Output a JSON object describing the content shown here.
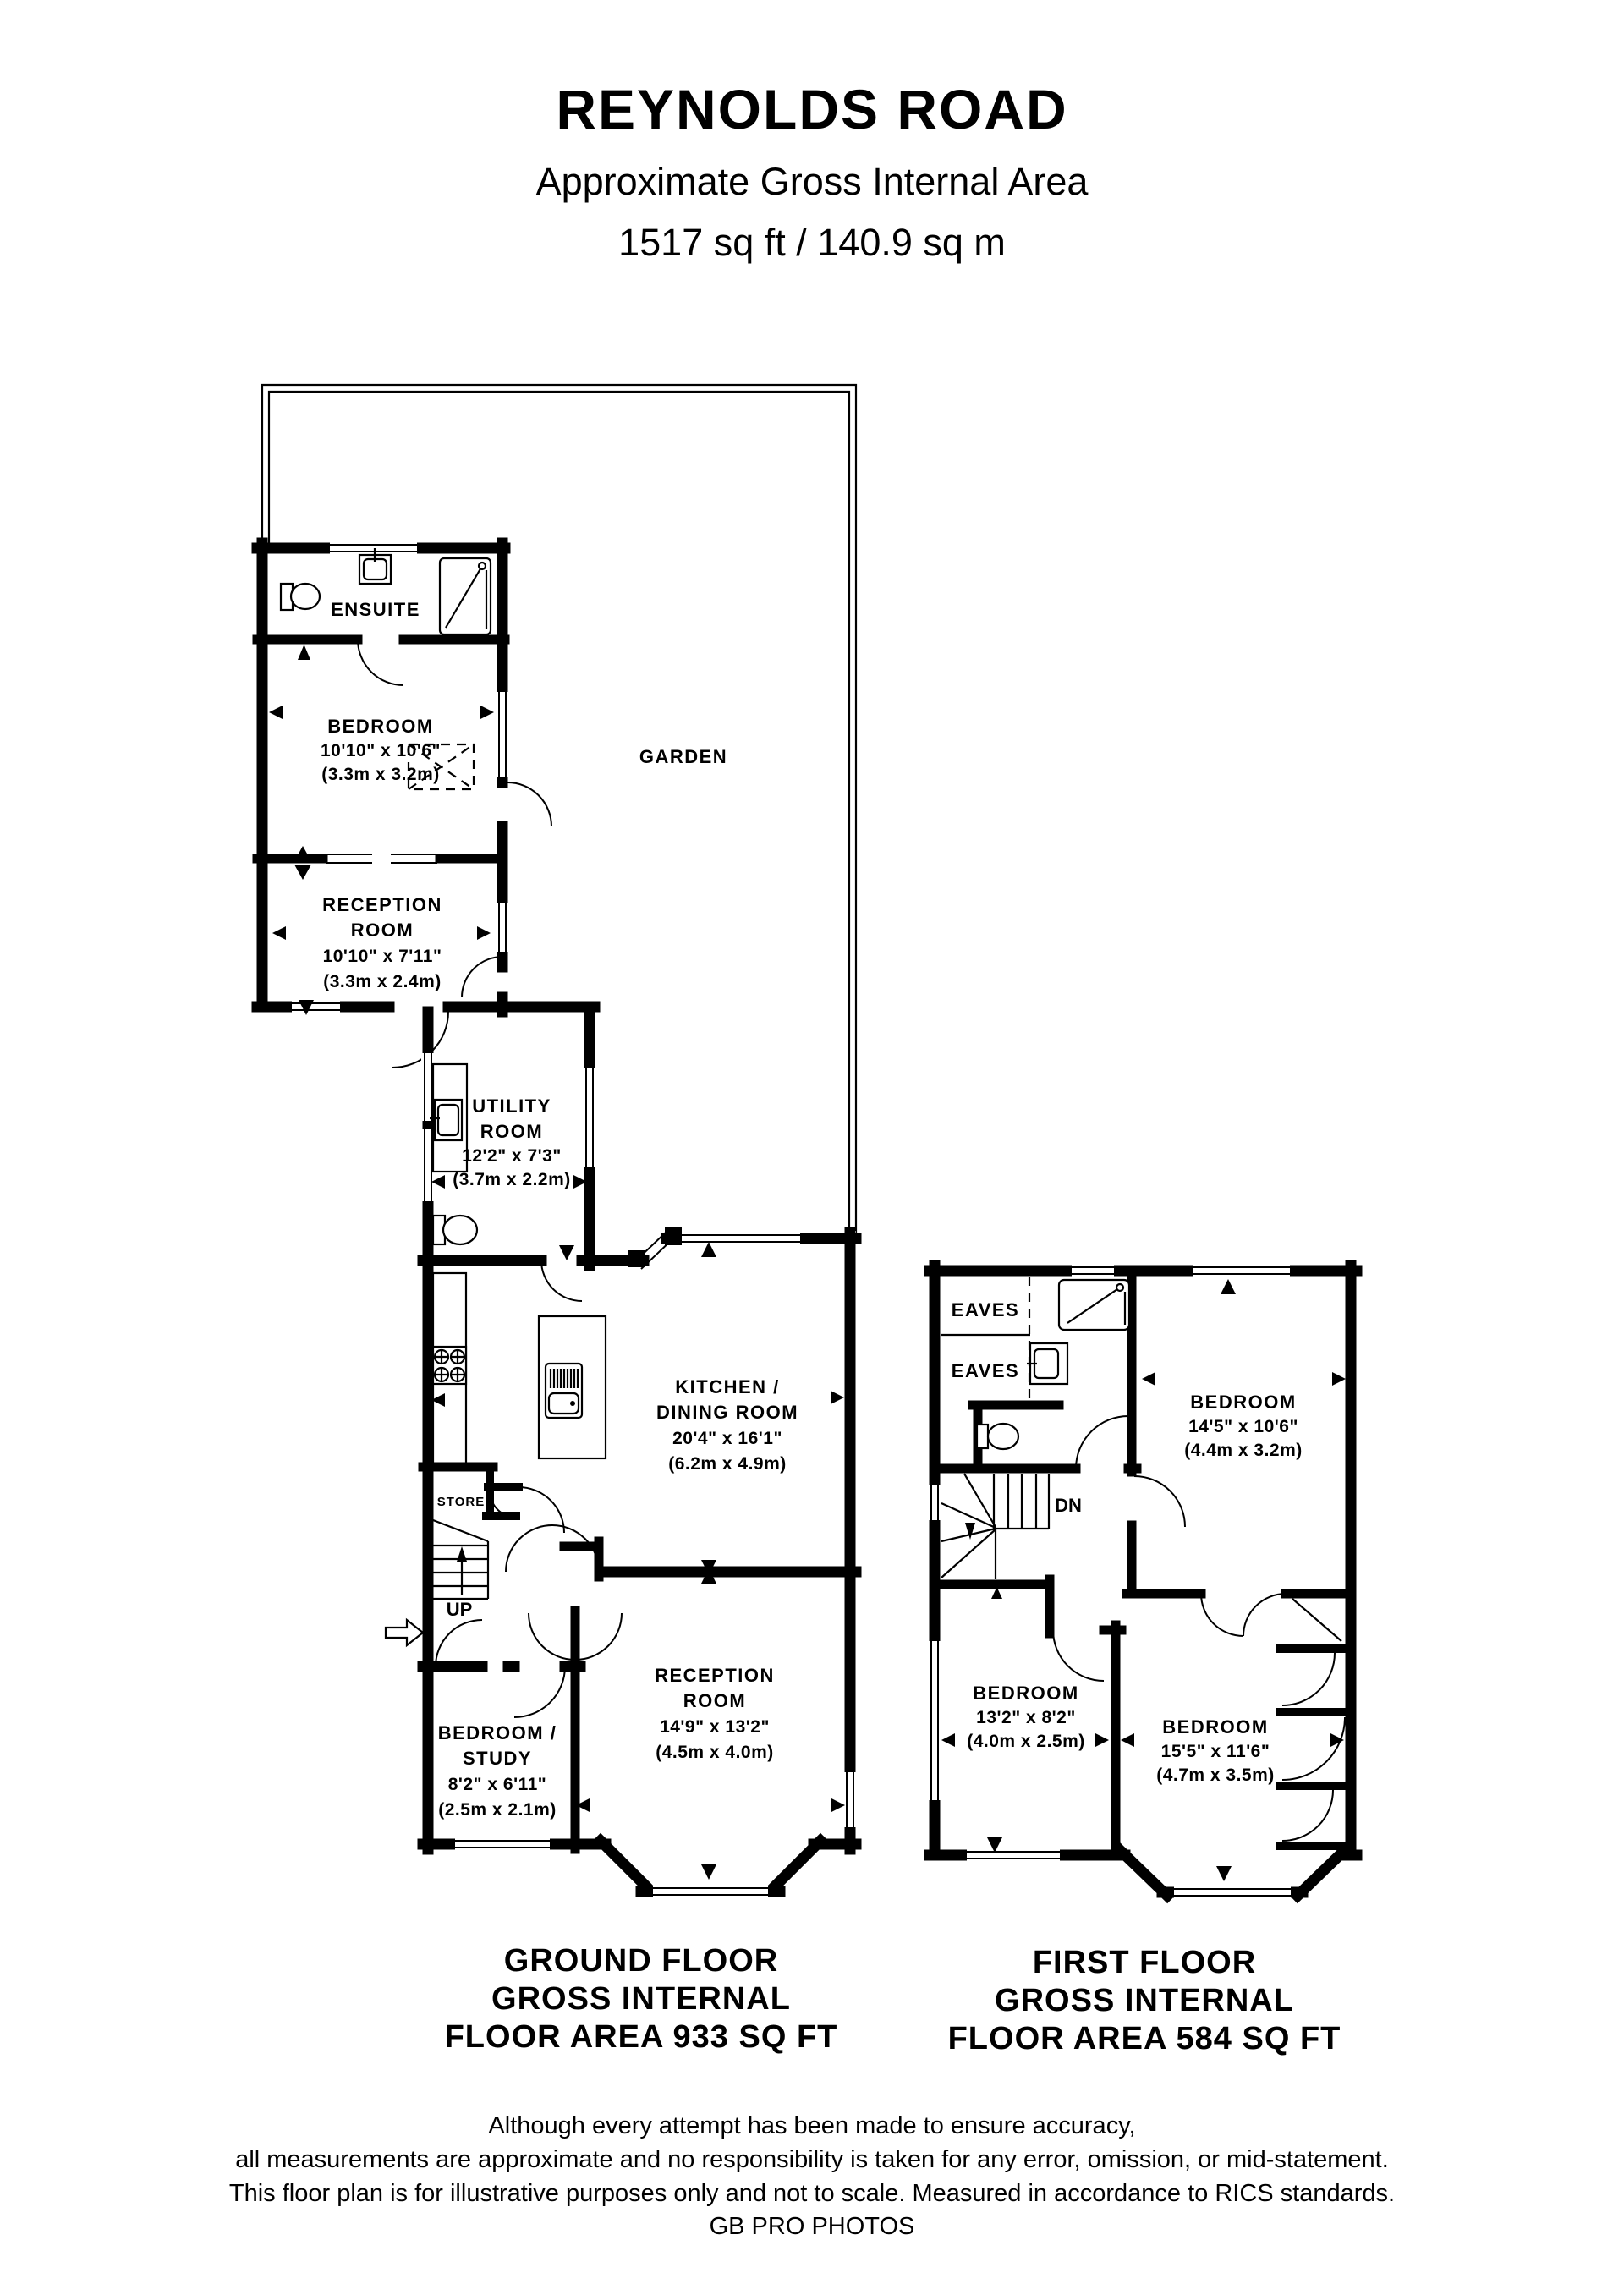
{
  "header": {
    "title": "REYNOLDS ROAD",
    "subtitle": "Approximate Gross Internal Area",
    "area": "1517 sq ft / 140.9 sq m"
  },
  "garden": {
    "label": "GARDEN"
  },
  "ground_floor": {
    "caption": [
      "GROUND FLOOR",
      "GROSS INTERNAL",
      "FLOOR AREA 933 SQ FT"
    ],
    "ensuite": {
      "name": "ENSUITE"
    },
    "bedroom_rear": {
      "name": "BEDROOM",
      "dims_ft": "10'10\" x 10'6\"",
      "dims_m": "(3.3m x 3.2m)"
    },
    "reception_rear": {
      "name_line1": "RECEPTION",
      "name_line2": "ROOM",
      "dims_ft": "10'10\" x 7'11\"",
      "dims_m": "(3.3m x 2.4m)"
    },
    "utility": {
      "name_line1": "UTILITY",
      "name_line2": "ROOM",
      "dims_ft": "12'2\" x 7'3\"",
      "dims_m": "(3.7m x 2.2m)"
    },
    "kitchen": {
      "name_line1": "KITCHEN /",
      "name_line2": "DINING ROOM",
      "dims_ft": "20'4\" x 16'1\"",
      "dims_m": "(6.2m x 4.9m)"
    },
    "store": {
      "name": "STORE"
    },
    "stairs": {
      "label": "UP"
    },
    "study": {
      "name_line1": "BEDROOM /",
      "name_line2": "STUDY",
      "dims_ft": "8'2\" x 6'11\"",
      "dims_m": "(2.5m x 2.1m)"
    },
    "reception_front": {
      "name_line1": "RECEPTION",
      "name_line2": "ROOM",
      "dims_ft": "14'9\" x 13'2\"",
      "dims_m": "(4.5m x 4.0m)"
    }
  },
  "first_floor": {
    "caption": [
      "FIRST FLOOR",
      "GROSS INTERNAL",
      "FLOOR AREA 584 SQ FT"
    ],
    "eaves_top": {
      "name": "EAVES"
    },
    "eaves_bottom": {
      "name": "EAVES"
    },
    "stairs": {
      "label": "DN"
    },
    "bedroom_rear": {
      "name": "BEDROOM",
      "dims_ft": "14'5\" x 10'6\"",
      "dims_m": "(4.4m x 3.2m)"
    },
    "bedroom_left": {
      "name": "BEDROOM",
      "dims_ft": "13'2\" x 8'2\"",
      "dims_m": "(4.0m x 2.5m)"
    },
    "bedroom_front": {
      "name": "BEDROOM",
      "dims_ft": "15'5\" x 11'6\"",
      "dims_m": "(4.7m x 3.5m)"
    }
  },
  "footer": {
    "line1": "Although every attempt has been made to ensure accuracy,",
    "line2": "all measurements are approximate and no responsibility is taken for any error, omission, or mid-statement.",
    "line3": "This floor plan is for illustrative purposes only and not to scale. Measured in accordance to RICS standards.",
    "line4": "GB PRO PHOTOS"
  },
  "colors": {
    "ink": "#000000",
    "background": "#ffffff"
  }
}
